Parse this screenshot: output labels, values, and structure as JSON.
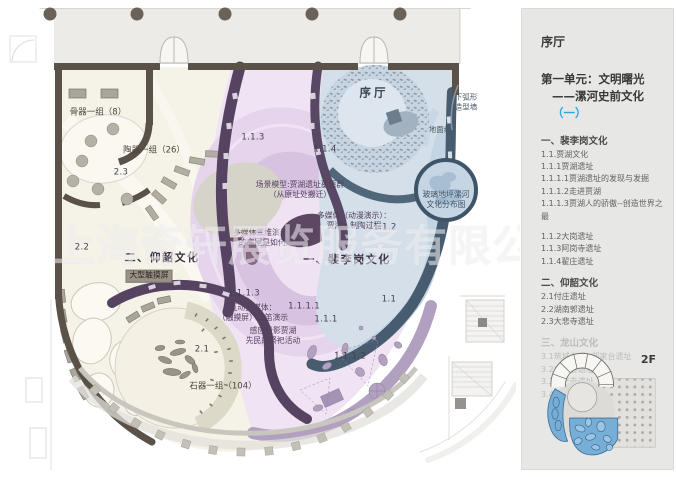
{
  "sidebar": {
    "hall_label": "序厅",
    "unit_line1": "第一单元：文明曙光",
    "unit_line2_prefix": "——漯河史前文化",
    "unit_highlight": "（一）",
    "accent_color": "#2aa7e0",
    "floor_label": "2F",
    "sections": [
      {
        "heading": "一、裴李岗文化",
        "faded": false,
        "items": [
          "1.1.贾湖文化",
          "1.1.1贾湖遗址",
          "1.1.1.1贾湖遗址的发现与发掘",
          "1.1.1.2走进贾湖",
          "1.1.1.3贾湖人的骄傲--创造世界之最",
          "",
          "1.1.2大岗遗址",
          "1.1.3阿岗寺遗址",
          "1.1.4翟庄遗址"
        ]
      },
      {
        "heading": "二、仰韶文化",
        "faded": false,
        "items": [
          "2.1付庄遗址",
          "2.2湖南郭遗址",
          "2.3大悲寺遗址"
        ]
      },
      {
        "heading": "三、龙山文化",
        "faded": true,
        "items": [
          "3.1筑城立邦--郝家台遗址",
          "3.2凌云台遗址",
          "3.3华严寺遗址",
          "3.4漯河市其它龙山文化遗址"
        ]
      }
    ]
  },
  "plan": {
    "watermark": "上海奇轩展览服务有限公司",
    "labels": [
      {
        "text": "骨器一组（8）",
        "x": 98,
        "y": 113,
        "cls": "room"
      },
      {
        "text": "陶器一组（26）",
        "x": 154,
        "y": 151,
        "cls": "room"
      },
      {
        "text": "2.3",
        "x": 121,
        "y": 173,
        "cls": "num"
      },
      {
        "text": "2.2",
        "x": 82,
        "y": 248,
        "cls": "num"
      },
      {
        "text": "二、仰韶文化",
        "x": 162,
        "y": 258,
        "cls": "zone"
      },
      {
        "text": "大型触摸屏",
        "x": 149,
        "y": 276,
        "cls": "chip"
      },
      {
        "text": "2.1",
        "x": 202,
        "y": 350,
        "cls": "num"
      },
      {
        "text": "石器一组（104）",
        "x": 223,
        "y": 387,
        "cls": "room"
      },
      {
        "text": "1.1.3",
        "x": 253,
        "y": 138,
        "cls": "num"
      },
      {
        "text": "1.1.4",
        "x": 325,
        "y": 150,
        "cls": "num"
      },
      {
        "text": "序厅",
        "x": 374,
        "y": 93,
        "cls": "hall"
      },
      {
        "text": "下弧形\n造型墙",
        "x": 466,
        "y": 102,
        "cls": "tiny"
      },
      {
        "text": "地面线",
        "x": 440,
        "y": 130,
        "cls": "tiny"
      },
      {
        "text": "场景模型:贾湖遗址墓葬群\n（从原址处搬迁）",
        "x": 300,
        "y": 190,
        "cls": "tag"
      },
      {
        "text": "多媒体（动漫演示）：\n贾湖人制陶过程",
        "x": 354,
        "y": 221,
        "cls": "tag"
      },
      {
        "text": "1.1.2",
        "x": 385,
        "y": 228,
        "cls": "num"
      },
      {
        "text": "多媒体三维演示：贾湖人\n的房屋是如何建造的?",
        "x": 276,
        "y": 238,
        "cls": "tag"
      },
      {
        "text": "一、裴李岗文化",
        "x": 347,
        "y": 260,
        "cls": "zone"
      },
      {
        "text": "1.1.1.3",
        "x": 244,
        "y": 294,
        "cls": "num"
      },
      {
        "text": "互动多媒体：\n（触摸屏）骨笛演示",
        "x": 253,
        "y": 313,
        "cls": "tag"
      },
      {
        "text": "1.1.1.1",
        "x": 304,
        "y": 307,
        "cls": "num"
      },
      {
        "text": "1.1.1",
        "x": 326,
        "y": 320,
        "cls": "num"
      },
      {
        "text": "感应投影贾湖\n先民的祭祀活动",
        "x": 273,
        "y": 336,
        "cls": "tag"
      },
      {
        "text": "1.1",
        "x": 389,
        "y": 300,
        "cls": "num"
      },
      {
        "text": "1.1.1.2",
        "x": 350,
        "y": 357,
        "cls": "num"
      },
      {
        "text": "玻璃地坪漯河\n文化分布图",
        "x": 446,
        "y": 200,
        "cls": "tag-blue"
      }
    ]
  }
}
